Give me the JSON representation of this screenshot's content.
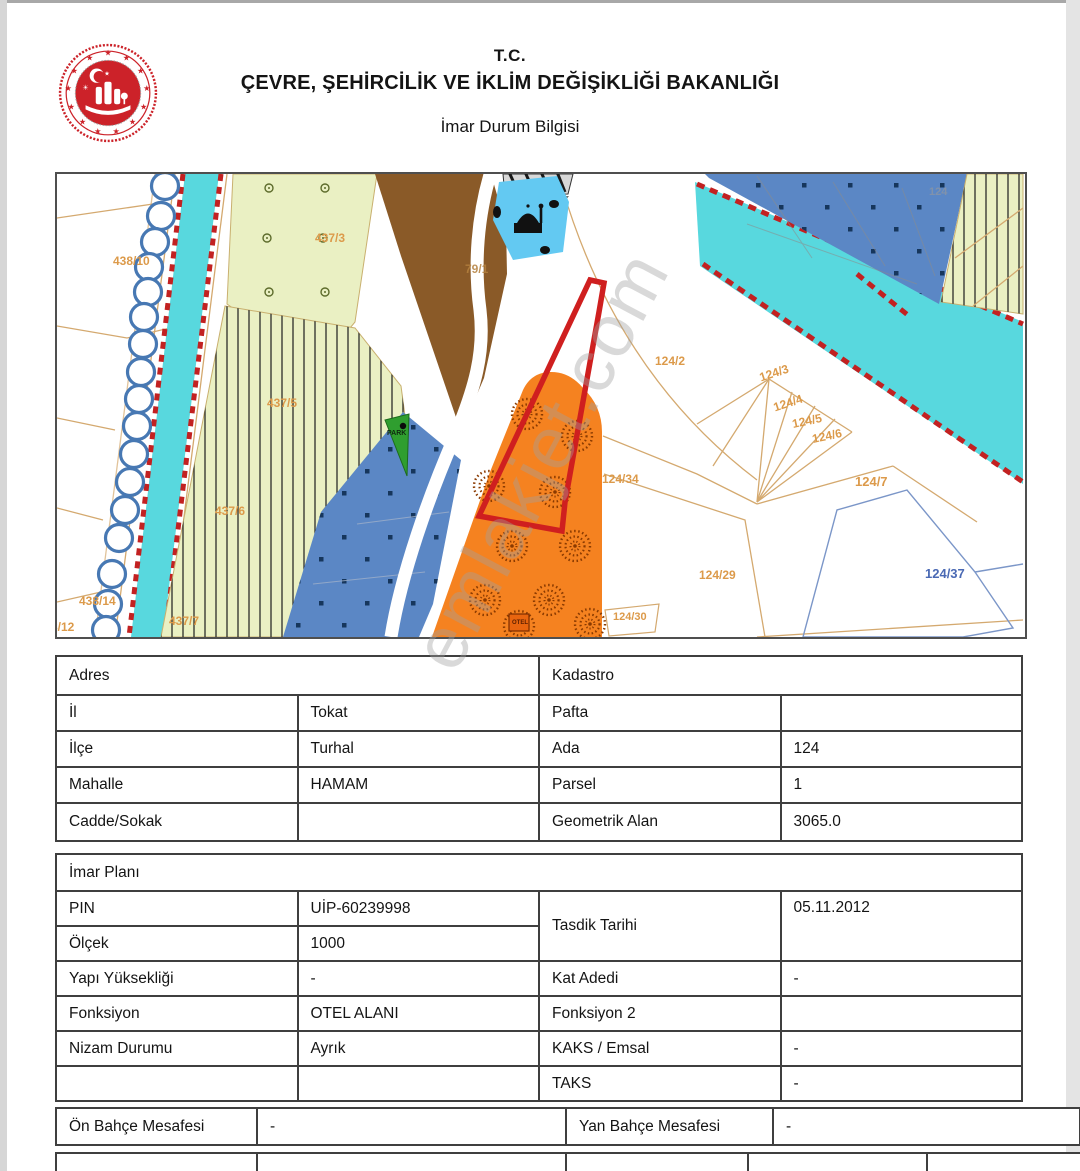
{
  "header": {
    "tc": "T.C.",
    "ministry": "ÇEVRE, ŞEHİRCİLİK VE İKLİM DEĞİŞİKLİĞİ BAKANLIĞI",
    "doc_title": "İmar Durum Bilgisi"
  },
  "watermark": {
    "text": "emlakjet.com"
  },
  "map": {
    "labels": {
      "l438_10": "438/10",
      "l437_3": "437/3",
      "l79_1": "79/1",
      "l437_5": "437/5",
      "l437_6": "437/6",
      "l437_7": "437/7",
      "l438_14": "438/14",
      "l8_12": "8/12",
      "l124_2": "124/2",
      "l124_34": "124/34",
      "l124_29": "124/29",
      "l124_3": "124/3",
      "l124_4": "124/4",
      "l124_5": "124/5",
      "l124_6": "124/6",
      "l124_7": "124/7",
      "l124_37": "124/37",
      "l124_30": "124/30",
      "l124_faint": "124",
      "park": "PARK",
      "otel": "OTEL"
    },
    "colors": {
      "canal": "#58d8de",
      "parcel_green": "#eaf0c3",
      "brown": "#8a5a28",
      "steel_blue": "#5b87c5",
      "light_blue": "#63c9f2",
      "orange": "#f58220",
      "boundary_red": "#cf1f1f",
      "label_orange": "#dc9a4a",
      "label_blue": "#4a69b4",
      "park_green": "#2f9e2f"
    }
  },
  "address_table": {
    "left_header": "Adres",
    "right_header": "Kadastro",
    "rows": [
      {
        "l": "İl",
        "lv": "Tokat",
        "r": "Pafta",
        "rv": ""
      },
      {
        "l": "İlçe",
        "lv": "Turhal",
        "r": "Ada",
        "rv": "124"
      },
      {
        "l": "Mahalle",
        "lv": "HAMAM",
        "r": "Parsel",
        "rv": "1"
      },
      {
        "l": "Cadde/Sokak",
        "lv": "",
        "r": "Geometrik Alan",
        "rv": "3065.0"
      }
    ]
  },
  "plan_table": {
    "header": "İmar Planı",
    "pin_label": "PIN",
    "pin_value": "UİP-60239998",
    "olcek_label": "Ölçek",
    "olcek_value": "1000",
    "tasdik_label": "Tasdik Tarihi",
    "tasdik_value": "05.11.2012",
    "yapi_label": "Yapı Yüksekliği",
    "yapi_value": "-",
    "kat_label": "Kat Adedi",
    "kat_value": "-",
    "fonksiyon_label": "Fonksiyon",
    "fonksiyon_value": "OTEL ALANI",
    "fonksiyon2_label": "Fonksiyon 2",
    "fonksiyon2_value": "",
    "nizam_label": "Nizam Durumu",
    "nizam_value": "Ayrık",
    "kaks_label": "KAKS / Emsal",
    "kaks_value": "-",
    "taks_label": "TAKS",
    "taks_value": "-"
  },
  "setback_row": {
    "on_label": "Ön Bahçe Mesafesi",
    "on_value": "-",
    "yan_label": "Yan Bahçe Mesafesi",
    "yan_value": "-"
  }
}
